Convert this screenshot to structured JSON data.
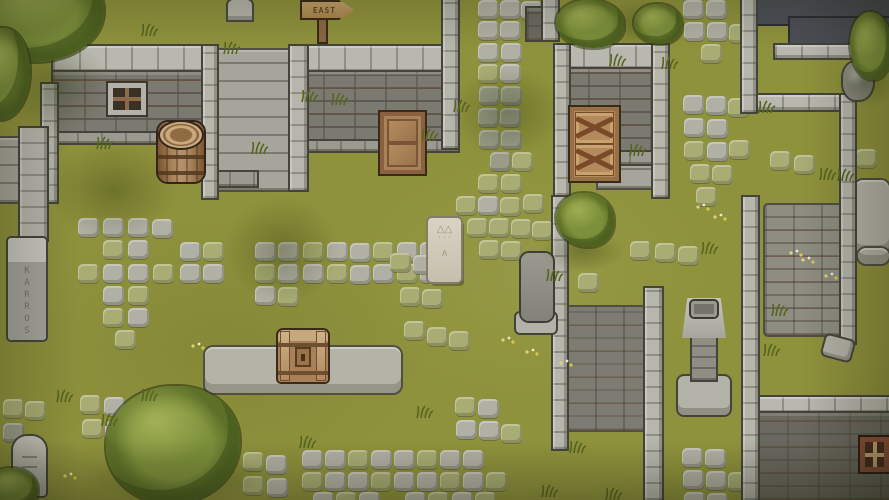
{
  "scene": {
    "title": "Top-down pixel-art village courtyard",
    "canvas": {
      "width": 889,
      "height": 500
    },
    "palette": {
      "grass": "#8f923c",
      "path_tile": "#b1b0a4",
      "mossy_tile": "#a9ad74",
      "wall_light": "#b9b8af",
      "wall_brick": "#7b7a71",
      "wall_brick_dark": "#6b6a61",
      "wood": "#a8835a",
      "wood_dark": "#8a6040",
      "foliage": "#7c8f3b",
      "dark_pool": "#4b4f55",
      "mortar_red": "#7a3e28",
      "tablet": "#d9d3c3"
    }
  },
  "sign": {
    "text": "EAST"
  },
  "rune_pillar": {
    "glyphs": "KARROS"
  },
  "tablet": {
    "glyphs": [
      "△△",
      "˙˙˙",
      "∧"
    ]
  },
  "structures": [
    {
      "t": "pool",
      "x": 753,
      "y": 0,
      "w": 136,
      "h": 24
    },
    {
      "t": "pool",
      "x": 790,
      "y": 18,
      "w": 99,
      "h": 26
    },
    {
      "t": "sf",
      "x": 215,
      "y": 50,
      "w": 79,
      "h": 140
    },
    {
      "t": "sf",
      "x": 0,
      "y": 138,
      "w": 20,
      "h": 64
    },
    {
      "t": "sf",
      "x": 598,
      "y": 160,
      "w": 70,
      "h": 28
    },
    {
      "t": "pv",
      "x": 765,
      "y": 205,
      "w": 82,
      "h": 130
    },
    {
      "t": "pvdk",
      "x": 567,
      "y": 307,
      "w": 78,
      "h": 123
    },
    {
      "t": "pf",
      "x": 205,
      "y": 347,
      "w": 196,
      "h": 46
    },
    {
      "t": "pf",
      "x": 855,
      "y": 180,
      "w": 34,
      "h": 74
    },
    {
      "t": "pf",
      "x": 858,
      "y": 248,
      "w": 31,
      "h": 16
    },
    {
      "t": "wb",
      "x": 53,
      "y": 46,
      "w": 164,
      "h": 26
    },
    {
      "t": "br",
      "x": 53,
      "y": 72,
      "w": 164,
      "h": 61
    },
    {
      "t": "wbd",
      "x": 53,
      "y": 133,
      "w": 164,
      "h": 10
    },
    {
      "t": "wb",
      "x": 292,
      "y": 46,
      "w": 166,
      "h": 26
    },
    {
      "t": "br",
      "x": 292,
      "y": 72,
      "w": 166,
      "h": 69
    },
    {
      "t": "wbd",
      "x": 292,
      "y": 141,
      "w": 166,
      "h": 10
    },
    {
      "t": "wb",
      "x": 557,
      "y": 45,
      "w": 111,
      "h": 24
    },
    {
      "t": "br",
      "x": 557,
      "y": 69,
      "w": 111,
      "h": 83
    },
    {
      "t": "wbd",
      "x": 557,
      "y": 152,
      "w": 111,
      "h": 12
    },
    {
      "t": "wbd",
      "x": 205,
      "y": 172,
      "w": 52,
      "h": 14
    },
    {
      "t": "wb",
      "x": 756,
      "y": 95,
      "w": 97,
      "h": 15
    },
    {
      "t": "wb",
      "x": 775,
      "y": 45,
      "w": 114,
      "h": 13
    },
    {
      "t": "wb",
      "x": 756,
      "y": 397,
      "w": 133,
      "h": 16
    },
    {
      "t": "brdk",
      "x": 756,
      "y": 413,
      "w": 133,
      "h": 87
    },
    {
      "t": "brdk",
      "x": 527,
      "y": 8,
      "w": 16,
      "h": 32
    },
    {
      "t": "wc",
      "x": 42,
      "y": 84,
      "w": 15,
      "h": 118
    },
    {
      "t": "wc",
      "x": 203,
      "y": 46,
      "w": 14,
      "h": 152
    },
    {
      "t": "wc",
      "x": 290,
      "y": 46,
      "w": 17,
      "h": 144
    },
    {
      "t": "wc",
      "x": 443,
      "y": 0,
      "w": 15,
      "h": 148
    },
    {
      "t": "wc",
      "x": 543,
      "y": 0,
      "w": 15,
      "h": 40
    },
    {
      "t": "wc",
      "x": 555,
      "y": 45,
      "w": 14,
      "h": 150
    },
    {
      "t": "wc",
      "x": 653,
      "y": 45,
      "w": 15,
      "h": 152
    },
    {
      "t": "wc",
      "x": 742,
      "y": 0,
      "w": 14,
      "h": 112
    },
    {
      "t": "wc",
      "x": 841,
      "y": 95,
      "w": 14,
      "h": 248
    },
    {
      "t": "wc",
      "x": 743,
      "y": 197,
      "w": 15,
      "h": 303
    },
    {
      "t": "wc",
      "x": 553,
      "y": 197,
      "w": 14,
      "h": 252
    },
    {
      "t": "wc",
      "x": 645,
      "y": 288,
      "w": 17,
      "h": 212
    },
    {
      "t": "wc",
      "x": 20,
      "y": 128,
      "w": 27,
      "h": 112
    },
    {
      "t": "win",
      "x": 108,
      "y": 83,
      "w": 38,
      "h": 32
    },
    {
      "t": "win2",
      "x": 860,
      "y": 437,
      "w": 29,
      "h": 35
    },
    {
      "t": "pd",
      "x": 678,
      "y": 298,
      "w": 52,
      "h": 117
    },
    {
      "t": "bkp",
      "x": 516,
      "y": 253,
      "w": 40,
      "h": 80
    },
    {
      "t": "rk",
      "x": 843,
      "y": 62,
      "w": 30,
      "h": 38
    },
    {
      "t": "fl",
      "x": 824,
      "y": 338,
      "w": 28,
      "h": 20
    },
    {
      "t": "bar",
      "x": 158,
      "y": 122,
      "w": 46,
      "h": 60
    },
    {
      "t": "cd",
      "x": 380,
      "y": 112,
      "w": 45,
      "h": 62
    },
    {
      "t": "cx",
      "x": 570,
      "y": 107,
      "w": 49,
      "h": 74
    },
    {
      "t": "chest",
      "x": 278,
      "y": 330,
      "w": 50,
      "h": 52
    },
    {
      "t": "sg",
      "x": 300,
      "y": 0,
      "w": 49,
      "h": 42
    },
    {
      "t": "tb",
      "x": 428,
      "y": 218,
      "w": 33,
      "h": 64
    },
    {
      "t": "rp",
      "x": 8,
      "y": 238,
      "w": 38,
      "h": 102
    },
    {
      "t": "gv",
      "x": 13,
      "y": 436,
      "w": 33,
      "h": 60
    },
    {
      "t": "gs",
      "x": 228,
      "y": 0,
      "w": 24,
      "h": 20
    }
  ],
  "tiles": [
    [
      478,
      0,
      0
    ],
    [
      500,
      0,
      0
    ],
    [
      521,
      1,
      0
    ],
    [
      478,
      21,
      0
    ],
    [
      500,
      21,
      0
    ],
    [
      478,
      43,
      0
    ],
    [
      501,
      43,
      0
    ],
    [
      478,
      64,
      1
    ],
    [
      500,
      64,
      0
    ],
    [
      479,
      86,
      2
    ],
    [
      501,
      86,
      2
    ],
    [
      478,
      108,
      2
    ],
    [
      500,
      108,
      2
    ],
    [
      479,
      130,
      2
    ],
    [
      501,
      130,
      2
    ],
    [
      490,
      152,
      2
    ],
    [
      512,
      152,
      1
    ],
    [
      478,
      174,
      1
    ],
    [
      501,
      174,
      1
    ],
    [
      456,
      196,
      1
    ],
    [
      478,
      196,
      0
    ],
    [
      500,
      197,
      1
    ],
    [
      523,
      194,
      1
    ],
    [
      467,
      218,
      1
    ],
    [
      489,
      218,
      1
    ],
    [
      511,
      219,
      1
    ],
    [
      532,
      221,
      1
    ],
    [
      479,
      240,
      1
    ],
    [
      501,
      241,
      1
    ],
    [
      78,
      218,
      0
    ],
    [
      103,
      218,
      0
    ],
    [
      128,
      218,
      0
    ],
    [
      152,
      219,
      0
    ],
    [
      103,
      240,
      1
    ],
    [
      128,
      240,
      0
    ],
    [
      180,
      242,
      0
    ],
    [
      203,
      242,
      1
    ],
    [
      255,
      242,
      0
    ],
    [
      278,
      242,
      0
    ],
    [
      303,
      242,
      1
    ],
    [
      327,
      242,
      0
    ],
    [
      350,
      243,
      0
    ],
    [
      373,
      242,
      1
    ],
    [
      397,
      242,
      0
    ],
    [
      420,
      242,
      0
    ],
    [
      78,
      264,
      1
    ],
    [
      103,
      264,
      0
    ],
    [
      128,
      264,
      0
    ],
    [
      153,
      264,
      1
    ],
    [
      180,
      264,
      0
    ],
    [
      203,
      264,
      0
    ],
    [
      255,
      264,
      1
    ],
    [
      278,
      264,
      0
    ],
    [
      303,
      264,
      0
    ],
    [
      327,
      264,
      1
    ],
    [
      350,
      265,
      0
    ],
    [
      373,
      264,
      0
    ],
    [
      397,
      264,
      1
    ],
    [
      420,
      264,
      0
    ],
    [
      443,
      264,
      1
    ],
    [
      103,
      286,
      0
    ],
    [
      128,
      286,
      1
    ],
    [
      255,
      286,
      0
    ],
    [
      278,
      287,
      1
    ],
    [
      103,
      308,
      1
    ],
    [
      128,
      308,
      0
    ],
    [
      115,
      330,
      1
    ],
    [
      390,
      253,
      1
    ],
    [
      413,
      255,
      0
    ],
    [
      400,
      287,
      1
    ],
    [
      422,
      289,
      1
    ],
    [
      404,
      321,
      1
    ],
    [
      427,
      327,
      1
    ],
    [
      449,
      331,
      1
    ],
    [
      302,
      450,
      0
    ],
    [
      325,
      450,
      0
    ],
    [
      348,
      450,
      1
    ],
    [
      371,
      450,
      0
    ],
    [
      394,
      450,
      0
    ],
    [
      417,
      450,
      1
    ],
    [
      440,
      450,
      0
    ],
    [
      463,
      450,
      0
    ],
    [
      302,
      472,
      1
    ],
    [
      325,
      472,
      0
    ],
    [
      348,
      472,
      0
    ],
    [
      371,
      472,
      1
    ],
    [
      394,
      472,
      0
    ],
    [
      417,
      472,
      0
    ],
    [
      440,
      472,
      1
    ],
    [
      463,
      472,
      0
    ],
    [
      486,
      472,
      1
    ],
    [
      313,
      492,
      0
    ],
    [
      336,
      492,
      1
    ],
    [
      359,
      492,
      0
    ],
    [
      405,
      492,
      0
    ],
    [
      428,
      492,
      1
    ],
    [
      452,
      492,
      0
    ],
    [
      475,
      492,
      1
    ],
    [
      455,
      397,
      1
    ],
    [
      478,
      399,
      0
    ],
    [
      456,
      420,
      0
    ],
    [
      479,
      421,
      0
    ],
    [
      501,
      424,
      1
    ],
    [
      80,
      395,
      1
    ],
    [
      104,
      397,
      0
    ],
    [
      82,
      419,
      1
    ],
    [
      105,
      421,
      0
    ],
    [
      3,
      399,
      1
    ],
    [
      25,
      401,
      1
    ],
    [
      3,
      423,
      2
    ],
    [
      243,
      452,
      1
    ],
    [
      266,
      455,
      0
    ],
    [
      243,
      476,
      1
    ],
    [
      267,
      478,
      0
    ],
    [
      683,
      0,
      0
    ],
    [
      706,
      0,
      0
    ],
    [
      684,
      22,
      0
    ],
    [
      707,
      22,
      0
    ],
    [
      729,
      24,
      1
    ],
    [
      701,
      44,
      1
    ],
    [
      683,
      95,
      0
    ],
    [
      706,
      96,
      0
    ],
    [
      728,
      98,
      1
    ],
    [
      684,
      118,
      0
    ],
    [
      707,
      119,
      0
    ],
    [
      684,
      141,
      1
    ],
    [
      707,
      142,
      0
    ],
    [
      729,
      140,
      1
    ],
    [
      690,
      164,
      1
    ],
    [
      712,
      165,
      1
    ],
    [
      696,
      187,
      1
    ],
    [
      630,
      241,
      1
    ],
    [
      655,
      243,
      1
    ],
    [
      678,
      246,
      1
    ],
    [
      578,
      273,
      1
    ],
    [
      770,
      151,
      1
    ],
    [
      794,
      155,
      1
    ],
    [
      856,
      149,
      1
    ],
    [
      682,
      448,
      0
    ],
    [
      705,
      449,
      0
    ],
    [
      683,
      470,
      0
    ],
    [
      706,
      471,
      0
    ],
    [
      728,
      472,
      1
    ],
    [
      684,
      492,
      0
    ],
    [
      707,
      493,
      0
    ]
  ],
  "shadows": [
    [
      48,
      140,
      130,
      100
    ],
    [
      225,
      195,
      115,
      110
    ],
    [
      448,
      66,
      118,
      92
    ],
    [
      85,
      450,
      190,
      55
    ],
    [
      540,
      230,
      85,
      42
    ],
    [
      595,
      0,
      95,
      48
    ],
    [
      836,
      56,
      62,
      52
    ],
    [
      0,
      40,
      110,
      95
    ]
  ],
  "foliage": [
    {
      "t": "bu",
      "x": 556,
      "y": 0,
      "w": 68,
      "h": 48
    },
    {
      "t": "bu",
      "x": 634,
      "y": 4,
      "w": 48,
      "h": 40
    },
    {
      "t": "bu",
      "x": 850,
      "y": 12,
      "w": 42,
      "h": 68
    },
    {
      "t": "bu",
      "x": 556,
      "y": 193,
      "w": 58,
      "h": 54
    },
    {
      "t": "bu",
      "x": -14,
      "y": 468,
      "w": 52,
      "h": 42
    },
    {
      "t": "tr",
      "x": -28,
      "y": -34,
      "w": 132,
      "h": 96
    },
    {
      "t": "tr",
      "x": -26,
      "y": 28,
      "w": 56,
      "h": 92
    },
    {
      "t": "tr",
      "x": 106,
      "y": 386,
      "w": 134,
      "h": 118
    }
  ],
  "tufts": [
    [
      140,
      22
    ],
    [
      222,
      40
    ],
    [
      300,
      88
    ],
    [
      330,
      91
    ],
    [
      420,
      127
    ],
    [
      452,
      98
    ],
    [
      95,
      135
    ],
    [
      250,
      140
    ],
    [
      628,
      142
    ],
    [
      757,
      99
    ],
    [
      700,
      240
    ],
    [
      545,
      267
    ],
    [
      770,
      302
    ],
    [
      818,
      166
    ],
    [
      836,
      167
    ],
    [
      540,
      483
    ],
    [
      568,
      439
    ],
    [
      604,
      486
    ],
    [
      100,
      412
    ],
    [
      55,
      388
    ],
    [
      140,
      387
    ],
    [
      415,
      404
    ],
    [
      762,
      342
    ],
    [
      298,
      434
    ],
    [
      660,
      55
    ],
    [
      608,
      52
    ]
  ],
  "flowers": [
    [
      500,
      330
    ],
    [
      524,
      342
    ],
    [
      558,
      353
    ],
    [
      695,
      197
    ],
    [
      788,
      243
    ],
    [
      823,
      266
    ],
    [
      190,
      336
    ],
    [
      62,
      466
    ],
    [
      712,
      207
    ],
    [
      800,
      250
    ]
  ]
}
